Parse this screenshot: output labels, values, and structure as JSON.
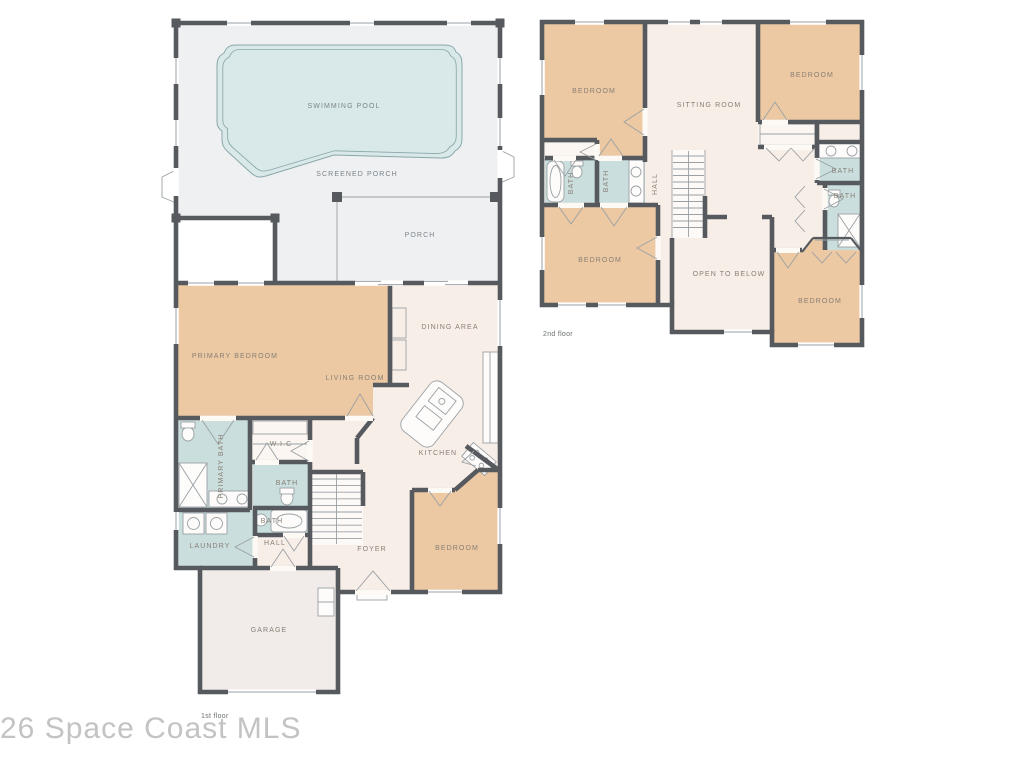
{
  "watermark": "26 Space Coast MLS",
  "colors": {
    "wall": "#565a5e",
    "bedroom": "#ecc9a3",
    "bath": "#cadedd",
    "living": "#f8eee8",
    "porch": "#eef0f1",
    "garage": "#f1ece9",
    "pool": "#d9e8e8",
    "pool_edge": "#8ba7ab",
    "closet": "#fbf6f1",
    "thin": "#9aa0a4",
    "label_warm": "#877f76",
    "label_cool": "#7c858c",
    "watermark": "#c4c3c2",
    "caption": "#6b7073"
  },
  "floors": {
    "first": {
      "caption": "1st floor",
      "labels": {
        "swimming_pool": "SWIMMING POOL",
        "screened_porch": "SCREENED PORCH",
        "porch": "PORCH",
        "dining_area": "DINING AREA",
        "living_room": "LIVING ROOM",
        "primary_bedroom": "PRIMARY BEDROOM",
        "primary_bath": "PRIMARY BATH",
        "wic": "W.I.C",
        "bath_upper": "BATH",
        "bath_lower": "BATH",
        "laundry": "LAUNDRY",
        "hall": "HALL",
        "foyer": "FOYER",
        "kitchen": "KITCHEN",
        "bedroom": "BEDROOM",
        "garage": "GARAGE"
      }
    },
    "second": {
      "caption": "2nd floor",
      "labels": {
        "bedroom_top_left": "BEDROOM",
        "sitting_room": "SITTING ROOM",
        "bedroom_top_right": "BEDROOM",
        "bath_left_tub": "BATH",
        "bath_left_vanity": "BATH",
        "hall": "HALL",
        "bath_right_upper": "BATH",
        "bath_right_lower": "BATH",
        "bedroom_bottom_left": "BEDROOM",
        "open_to_below": "OPEN TO BELOW",
        "bedroom_bottom_right": "BEDROOM"
      }
    }
  }
}
